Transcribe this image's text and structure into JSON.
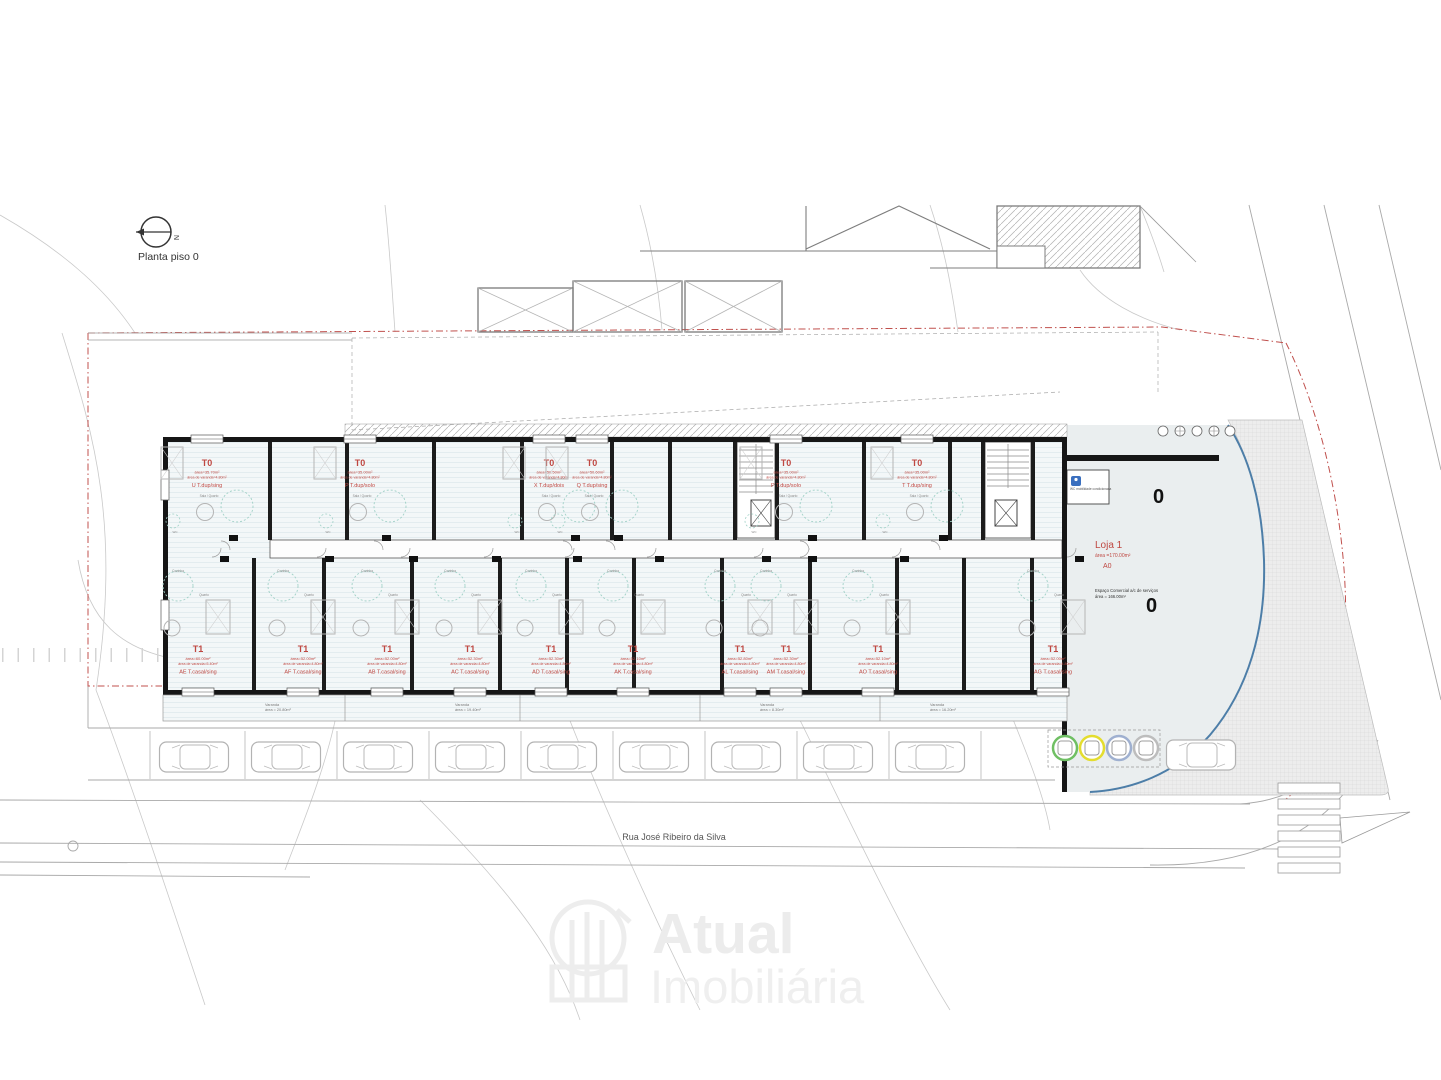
{
  "plan": {
    "title": "Planta piso 0",
    "north": "N",
    "column_marker": "0"
  },
  "street": {
    "name": "Rua José Ribeiro da Silva"
  },
  "loja": {
    "name": "Loja 1",
    "area": "área =170.00m²",
    "code": "A0",
    "note1": "Espaço Comercial a/c de serviços",
    "note2": "área = 166.00m²",
    "wc": "WC mobilidade condicionada"
  },
  "rooms": {
    "sala_quarto": "Sala / Quarto",
    "cozinha": "Cozinha",
    "quarto": "Quarto",
    "sala": "Sala",
    "arrumos": "Arrumos",
    "wc": "WC",
    "lavandaria": "Lavandaria"
  },
  "units": {
    "t0": [
      {
        "label": "T0",
        "area": "área=35.70m²",
        "varanda": "área de varanda=4.80m²",
        "code": "U",
        "type": "T.dup/sing"
      },
      {
        "label": "T0",
        "area": "área=35.00m²",
        "varanda": "área de varanda=4.80m²",
        "code": "P",
        "type": "T.dup/solo"
      },
      {
        "label": "T0",
        "area": "área=50.50m²",
        "varanda": "área de varanda=4.80m²",
        "code": "X",
        "type": "T.dup/dois"
      },
      {
        "label": "T0",
        "area": "área=50.60m²",
        "varanda": "área de varanda=4.80m²",
        "code": "Q",
        "type": "T.dup/sing"
      },
      {
        "label": "T0",
        "area": "área=35.00m²",
        "varanda": "área de varanda=4.80m²",
        "code": "P",
        "type": "T.dup/solo"
      },
      {
        "label": "T0",
        "area": "área=35.00m²",
        "varanda": "área de varanda=4.80m²",
        "code": "T",
        "type": "T.dup/sing"
      }
    ],
    "t1": [
      {
        "label": "T1",
        "area": "área=60.00m²",
        "varanda": "área de varanda=5.40m²",
        "code": "AE",
        "type": "T.casal/sing"
      },
      {
        "label": "T1",
        "area": "área=52.00m²",
        "varanda": "área de varanda=4.80m²",
        "code": "AF",
        "type": "T.casal/sing"
      },
      {
        "label": "T1",
        "area": "área=52.00m²",
        "varanda": "área de varanda=4.80m²",
        "code": "AB",
        "type": "T.casal/sing"
      },
      {
        "label": "T1",
        "area": "área=52.30m²",
        "varanda": "área de varanda=4.80m²",
        "code": "AC",
        "type": "T.casal/sing"
      },
      {
        "label": "T1",
        "area": "área=52.30m²",
        "varanda": "área de varanda=4.80m²",
        "code": "AD",
        "type": "T.casal/sing"
      },
      {
        "label": "T1",
        "area": "área=52.10m²",
        "varanda": "área de varanda=4.80m²",
        "code": "AK",
        "type": "T.casal/sing"
      },
      {
        "label": "T1",
        "area": "área=52.80m²",
        "varanda": "área de varanda=4.80m²",
        "code": "AL",
        "type": "T.casal/sing"
      },
      {
        "label": "T1",
        "area": "área=52.30m²",
        "varanda": "área de varanda=4.80m²",
        "code": "AM",
        "type": "T.casal/sing"
      },
      {
        "label": "T1",
        "area": "área=52.10m²",
        "varanda": "área de varanda=4.80m²",
        "code": "AO",
        "type": "T.casal/sing"
      },
      {
        "label": "T1",
        "area": "área=52.00m²",
        "varanda": "área de varanda=4.80m²",
        "code": "AG",
        "type": "T.casal/sing"
      }
    ]
  },
  "varandas": [
    {
      "label": "Varanda",
      "area": "área = 20.80m²"
    },
    {
      "label": "Varanda",
      "area": "área = 19.40m²"
    },
    {
      "label": "Varanda",
      "area": "área = 8.30m²"
    },
    {
      "label": "Varanda",
      "area": "área = 16.20m²"
    }
  ],
  "watermark": {
    "line1": "Atual",
    "line2": "Imobiliária"
  },
  "bins": {
    "colors": [
      "#6fbf63",
      "#e4dd2e",
      "#9fb0d0",
      "#bdbdbd"
    ]
  },
  "colors": {
    "unit_label": "#bf4741",
    "wall": "#161616",
    "boundary": "#c0504d",
    "plaza_edge": "#4d7ea8"
  }
}
